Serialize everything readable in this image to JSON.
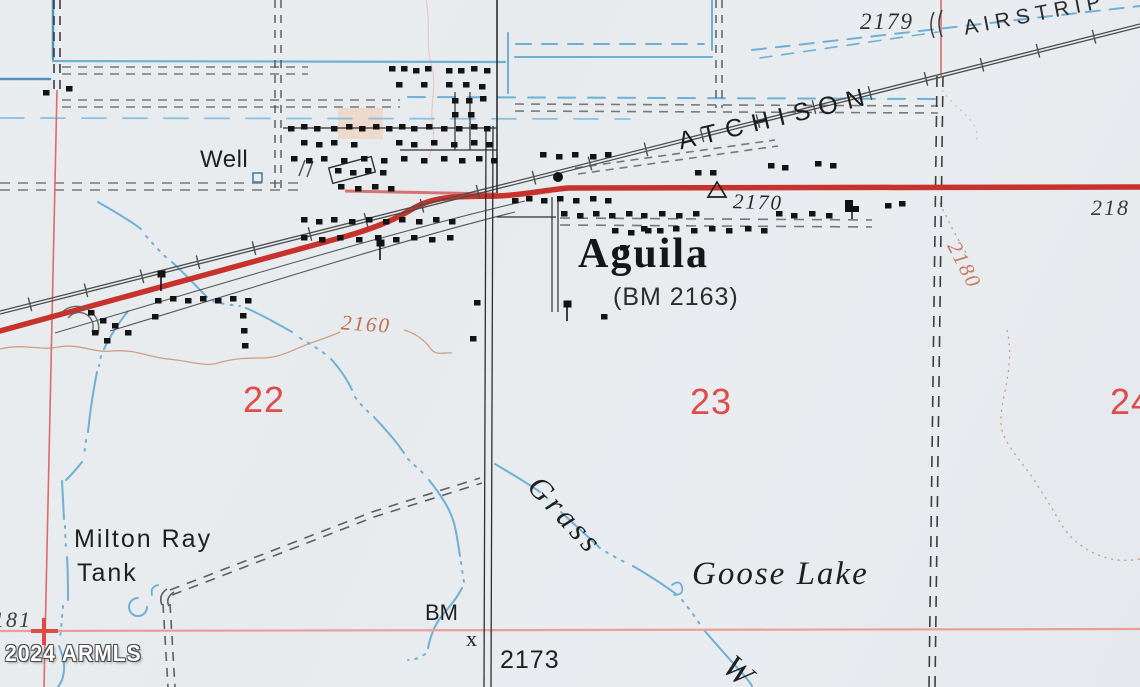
{
  "map": {
    "labels": {
      "well": "Well",
      "railroad_name": "ATCHISON",
      "airstrip": "AIRSTRIP",
      "elevation_2179": "2179",
      "spot_elevation_2170": "2170",
      "town_name": "Aguila",
      "town_benchmark": "(BM 2163)",
      "contour_2160": "2160",
      "contour_2180": "2180",
      "elevation_218_partial": "218",
      "section_22": "22",
      "section_23": "23",
      "section_24": "24",
      "tank_name_line1": "Milton Ray",
      "tank_name_line2": "Tank",
      "wash_name": "Grass",
      "lake_name": "Goose Lake",
      "benchmark_label": "BM",
      "benchmark_mark": "x",
      "benchmark_elevation": "2173",
      "contour_181_partial": "181",
      "wash_w_partial": "W"
    },
    "watermark": "2024 ARMLS",
    "symbols": {
      "benchmark_triangle": "open-triangle-2170",
      "benchmark_x": "x-mark-2173",
      "section_corner_cross": "red-plus",
      "tank": "open-blue-circle",
      "well_marker": "small-open-square"
    },
    "colors": {
      "paper": "#e9ecef",
      "highway_red": "#c8322d",
      "section_line_red": "#dd6b6b",
      "section_number_red": "#e04b4b",
      "water_blue": "#6fb0d5",
      "contour_brown": "#c07a5c",
      "railroad_gray": "#4d4d4d",
      "building_black": "#131313"
    }
  }
}
